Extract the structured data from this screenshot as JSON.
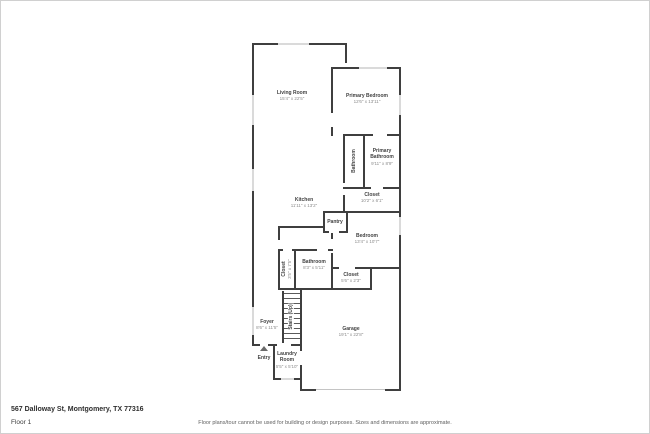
{
  "footer": {
    "address": "567 Dalloway St, Montgomery, TX 77316",
    "floor_label": "Floor 1",
    "disclaimer": "Floor plans/tour cannot be used for building or design purposes. Sizes and dimensions are approximate."
  },
  "rooms": [
    {
      "name": "Living Room",
      "dims": "15'4\" x 22'5\""
    },
    {
      "name": "Primary Bedroom",
      "dims": "12'6\" x 13'11\""
    },
    {
      "name": "Primary Bathroom",
      "dims": "9'11\" x 8'9\""
    },
    {
      "name": "Bathroom",
      "dims": ""
    },
    {
      "name": "Closet",
      "dims": "10'2\" x 6'1\""
    },
    {
      "name": "Kitchen",
      "dims": "11'11\" x 13'2\""
    },
    {
      "name": "Pantry",
      "dims": ""
    },
    {
      "name": "Bedroom",
      "dims": "13'4\" x 10'7\""
    },
    {
      "name": "Closet",
      "dims": "3'5\" x 7'5\""
    },
    {
      "name": "Bathroom",
      "dims": "8'3\" x 5'11\""
    },
    {
      "name": "Closet",
      "dims": "5'6\" x 2'3\""
    },
    {
      "name": "Stairs (Up)",
      "dims": ""
    },
    {
      "name": "Foyer",
      "dims": "8'6\" x 11'5\""
    },
    {
      "name": "Entry",
      "dims": ""
    },
    {
      "name": "Laundry Room",
      "dims": "5'5\" x 5'10\""
    },
    {
      "name": "Garage",
      "dims": "19'1\" x 22'8\""
    }
  ],
  "colors": {
    "wall": "#3f3f3f",
    "window": "#dadada",
    "garage_door": "#c4c4c4"
  }
}
